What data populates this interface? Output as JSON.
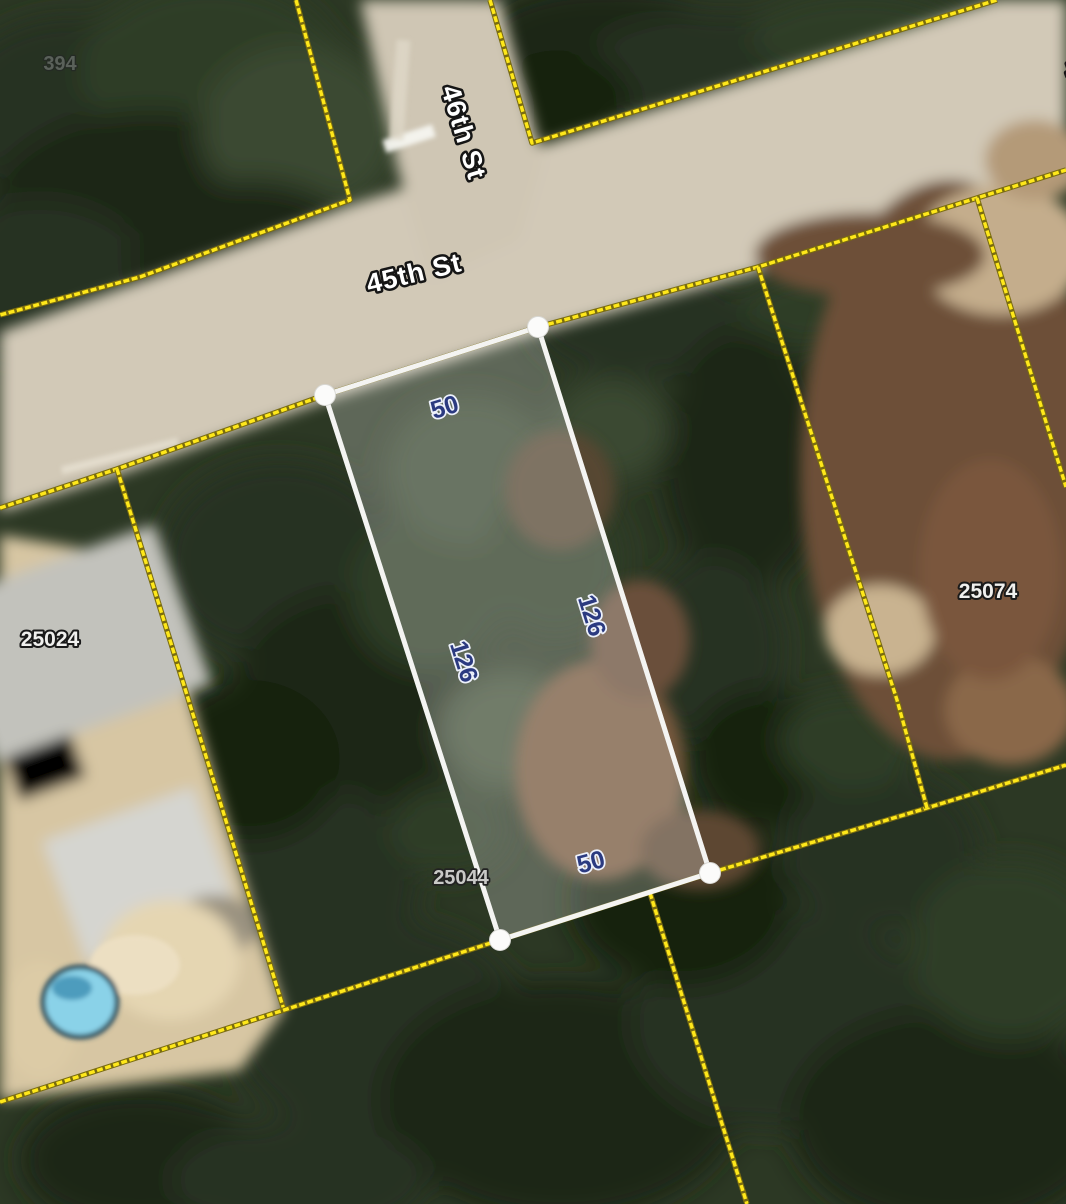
{
  "map": {
    "street_labels": [
      {
        "name": "46th St"
      },
      {
        "name": "45th St"
      },
      {
        "name": "4"
      }
    ],
    "parcel_labels": [
      {
        "id": "394"
      },
      {
        "id": "25024"
      },
      {
        "id": "25074"
      },
      {
        "id": "25044"
      }
    ],
    "selected_parcel": {
      "edge_labels": [
        "50",
        "126",
        "126",
        "50"
      ]
    },
    "colors": {
      "boundary_line": "#ffe81a",
      "selection_outline": "#ffffff",
      "dimension_text": "#2b3a80",
      "street_text": "#ffffff"
    }
  }
}
